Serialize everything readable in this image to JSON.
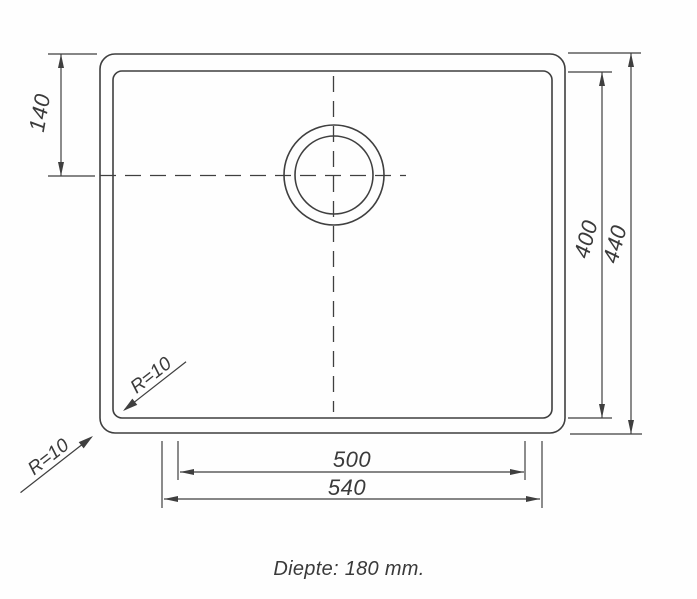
{
  "drawing": {
    "subject": "sink-top-view-technical-drawing",
    "line_color": "#3f3f3f",
    "text_color": "#3a3a3a",
    "background": "#fefefe",
    "labels": {
      "dim_top_offset": "140",
      "dim_inner_height": "400",
      "dim_outer_height": "440",
      "dim_inner_width": "500",
      "dim_outer_width": "540",
      "radius_inner": "R=10",
      "radius_outer": "R=10",
      "depth_note": "Diepte: 180 mm."
    }
  }
}
